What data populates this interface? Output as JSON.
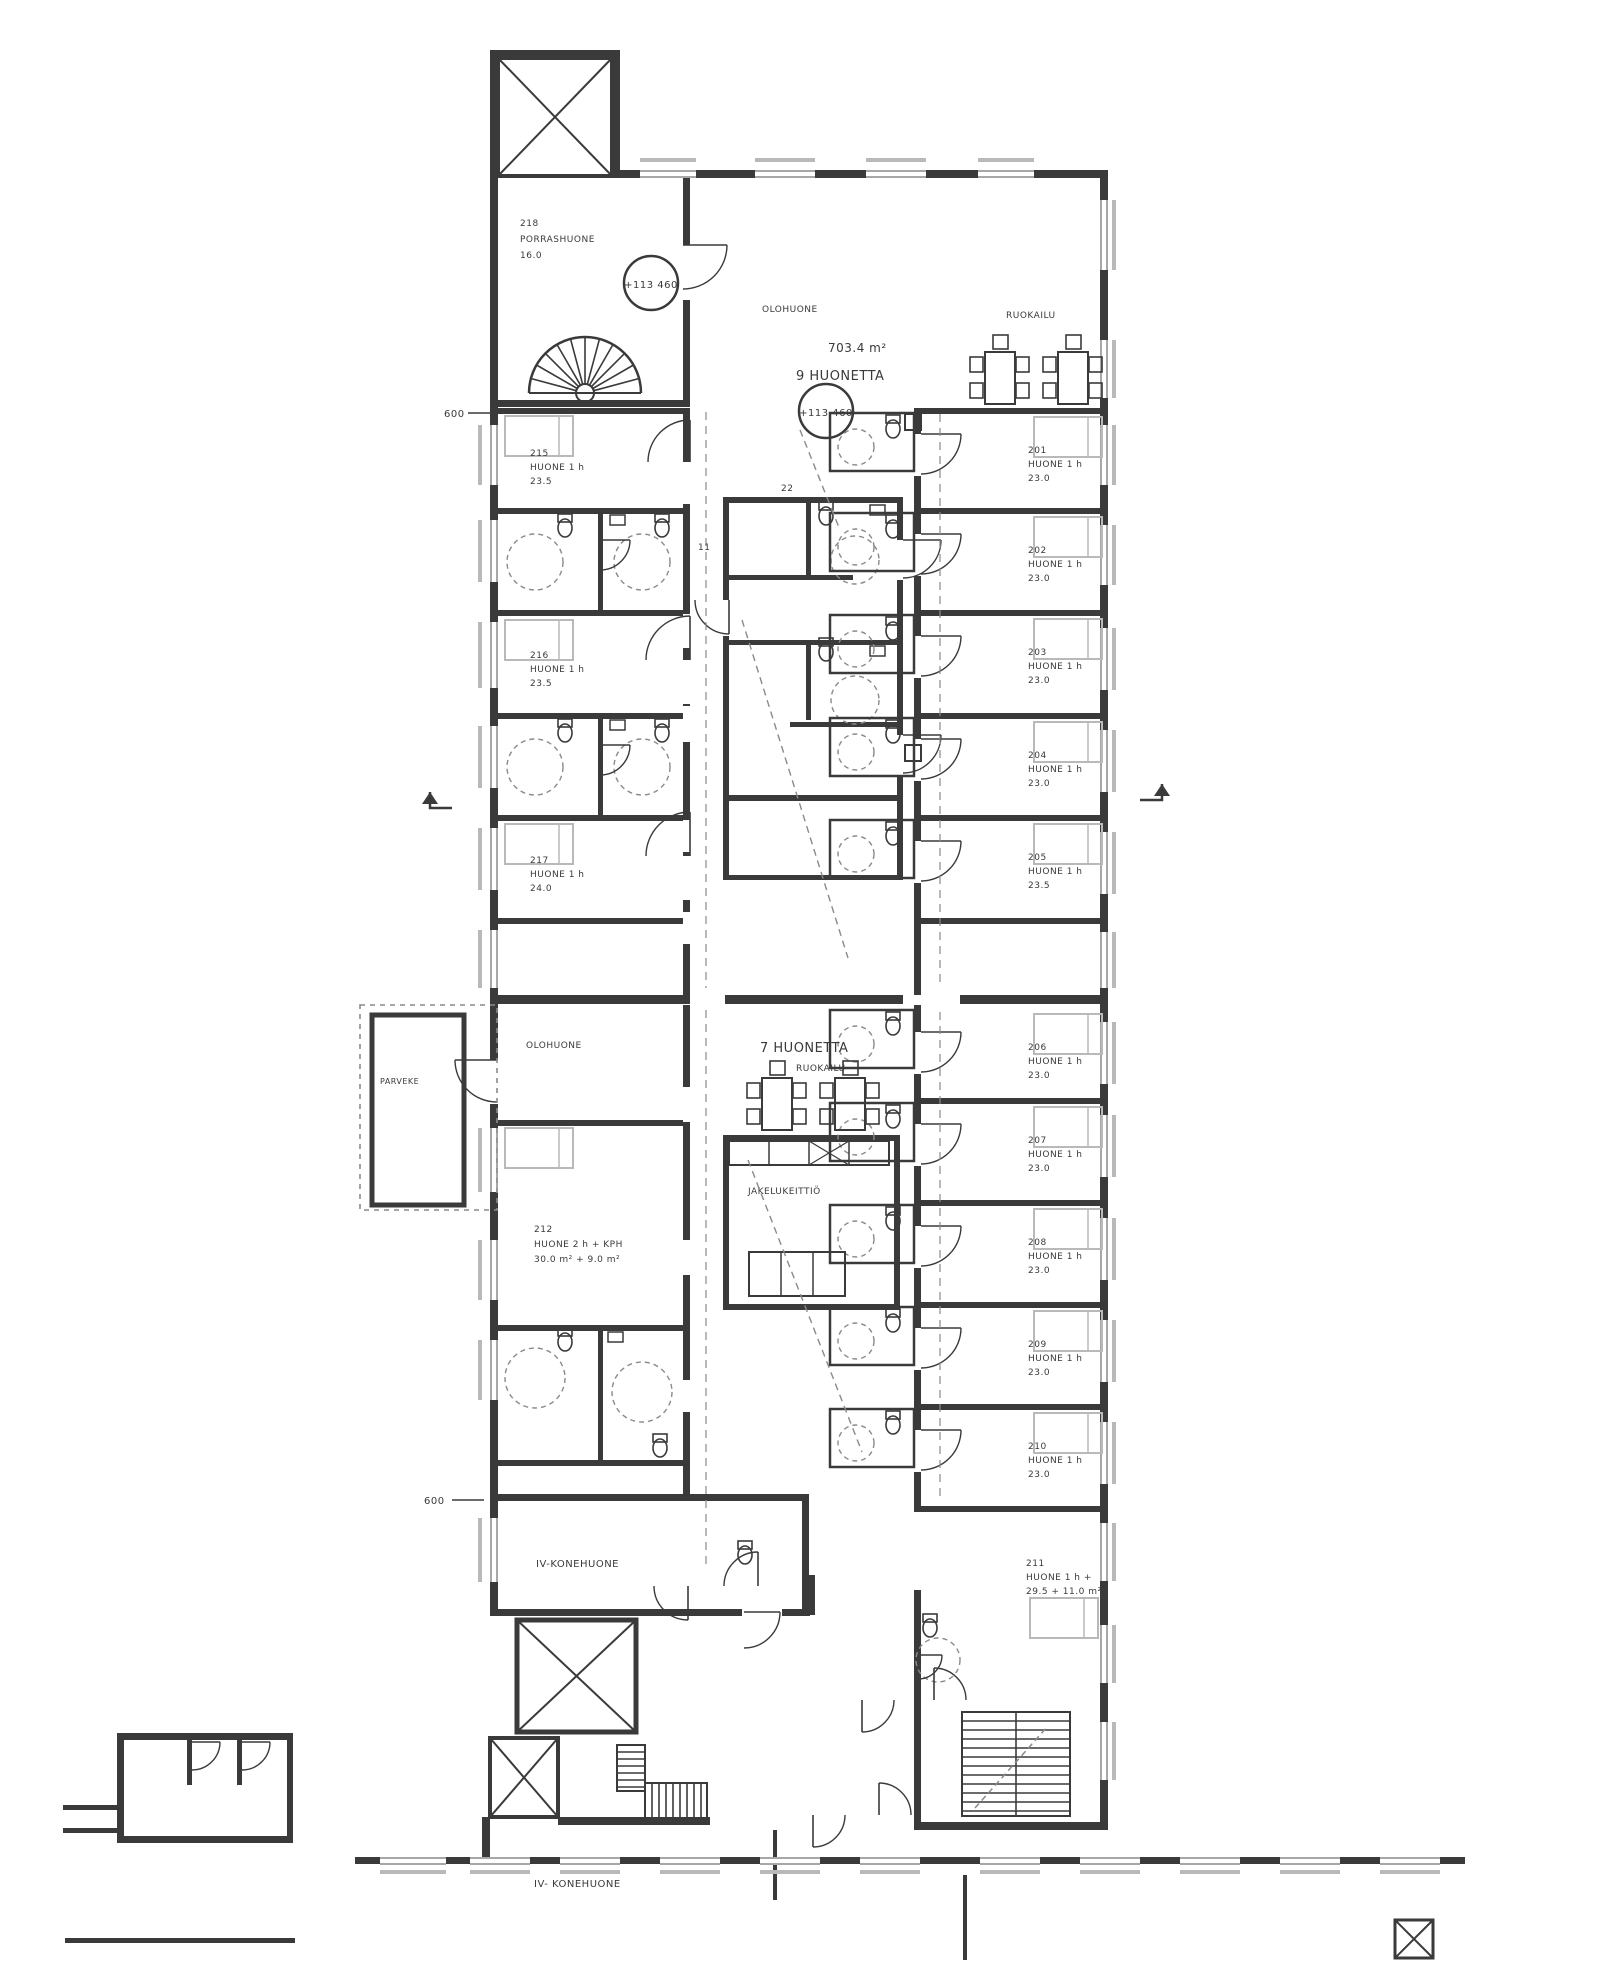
{
  "plan": {
    "labels": {
      "total_area": "703.4 m²",
      "upper_rooms": "9 HUONETTA",
      "lower_rooms": "7 HUONETTA",
      "elevation_hall": "+113 460",
      "elevation_upper": "+113 460",
      "machine_room": "IV-KONEHUONE",
      "machine_room_note": "IV- KONEHUONE",
      "dim_left": "600",
      "dim_lower": "600",
      "stair_hall_num": "218",
      "stair_hall_name": "PORRASHUONE",
      "stair_hall_area": "16.0",
      "living_upper": "OLOHUONE",
      "dining_upper": "RUOKAILU",
      "living_lower": "OLOHUONE",
      "dining_lower": "RUOKAILU",
      "kitchen": "JAKELUKEITTIÖ",
      "balcony": "PARVEKE",
      "mark_11": "11",
      "mark_22": "22",
      "suite_num": "211",
      "suite_type": "HUONE 1 h +",
      "suite_area": "29.5 + 11.0 m²",
      "family_num": "212",
      "family_type": "HUONE 2 h + KPH",
      "family_area": "30.0 m² + 9.0 m²"
    },
    "rooms": {
      "right_upper": [
        {
          "num": "201",
          "type": "HUONE 1 h",
          "area": "23.0"
        },
        {
          "num": "202",
          "type": "HUONE 1 h",
          "area": "23.0"
        },
        {
          "num": "203",
          "type": "HUONE 1 h",
          "area": "23.0"
        },
        {
          "num": "204",
          "type": "HUONE 1 h",
          "area": "23.0"
        },
        {
          "num": "205",
          "type": "HUONE 1 h",
          "area": "23.5"
        }
      ],
      "right_lower": [
        {
          "num": "206",
          "type": "HUONE 1 h",
          "area": "23.0"
        },
        {
          "num": "207",
          "type": "HUONE 1 h",
          "area": "23.0"
        },
        {
          "num": "208",
          "type": "HUONE 1 h",
          "area": "23.0"
        },
        {
          "num": "209",
          "type": "HUONE 1 h",
          "area": "23.0"
        },
        {
          "num": "210",
          "type": "HUONE 1 h",
          "area": "23.0"
        }
      ],
      "left_upper": [
        {
          "num": "215",
          "type": "HUONE 1 h",
          "area": "23.5"
        },
        {
          "num": "216",
          "type": "HUONE 1 h",
          "area": "23.5"
        },
        {
          "num": "217",
          "type": "HUONE 1 h",
          "area": "24.0"
        }
      ]
    }
  }
}
